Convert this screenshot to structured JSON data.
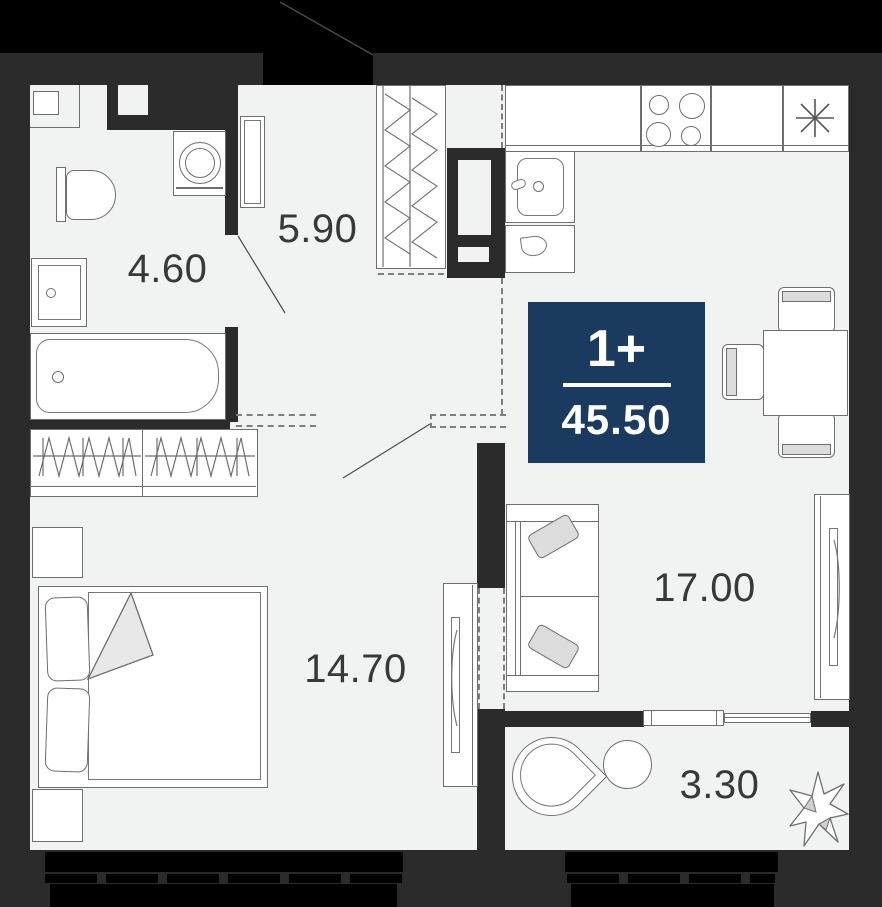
{
  "plan": {
    "badge": {
      "type": "1+",
      "area": "45.50",
      "bg_color": "#1b3a5f",
      "text_color": "#ffffff"
    },
    "rooms": [
      {
        "id": "bathroom",
        "area": "4.60"
      },
      {
        "id": "hallway",
        "area": "5.90"
      },
      {
        "id": "bedroom",
        "area": "14.70"
      },
      {
        "id": "living-kitchen",
        "area": "17.00"
      },
      {
        "id": "balcony",
        "area": "3.30"
      }
    ],
    "colors": {
      "background": "#000000",
      "wall": "#2b2b2b",
      "floor": "#f1f2f2",
      "furniture_outline": "#6e6e6e",
      "label_text": "#383838"
    },
    "icons": {
      "fridge": "snowflake-asterisk"
    }
  }
}
